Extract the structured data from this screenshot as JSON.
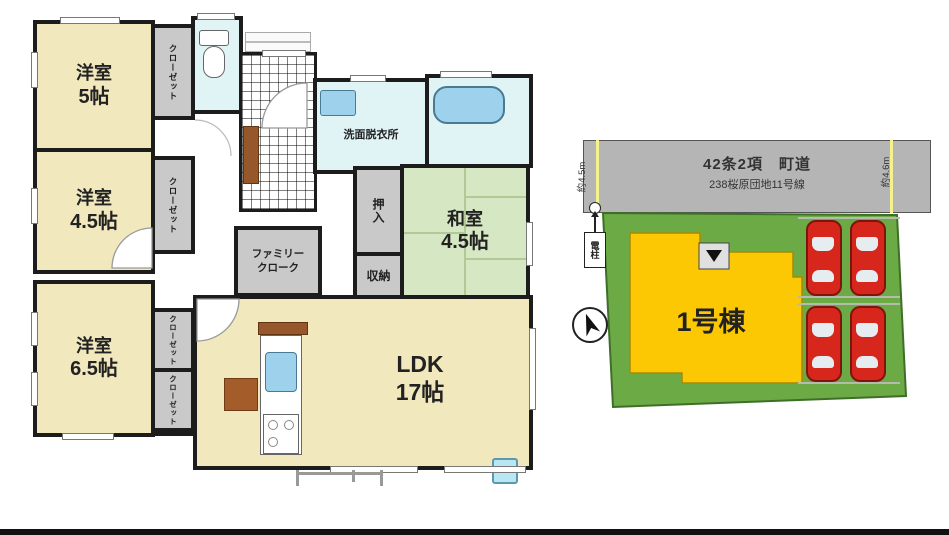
{
  "floorplan": {
    "rooms": {
      "western5": {
        "name": "洋室",
        "size": "5帖"
      },
      "western45": {
        "name": "洋室",
        "size": "4.5帖"
      },
      "western65": {
        "name": "洋室",
        "size": "6.5帖"
      },
      "japanese45": {
        "name": "和室",
        "size": "4.5帖"
      },
      "ldk": {
        "name": "LDK",
        "size": "17帖"
      },
      "washroom": "洗面脱衣所",
      "closet": "クローゼット",
      "oshiire": "押入",
      "storage": "収納",
      "family_cloak": {
        "line1": "ファミリー",
        "line2": "クローク"
      }
    }
  },
  "siteplan": {
    "road": {
      "classification": "42条2項　町道",
      "route": "238桜原団地11号線"
    },
    "frontage_left": "約4.5m",
    "frontage_right": "約4.6m",
    "utility_pole": "電柱",
    "building": "1号棟"
  },
  "colors": {
    "room_cream": "#f1e9bd",
    "tatami_green": "#d6e7c3",
    "water_blue": "#e0f3f5",
    "closet_gray": "#c9c9c9",
    "wall_black": "#1c1c1c",
    "road_gray": "#b5b5b5",
    "plot_green": "#6caa46",
    "building_yellow": "#fcc703",
    "car_red": "#d7261c",
    "measure_yellow": "#f5f18c"
  }
}
